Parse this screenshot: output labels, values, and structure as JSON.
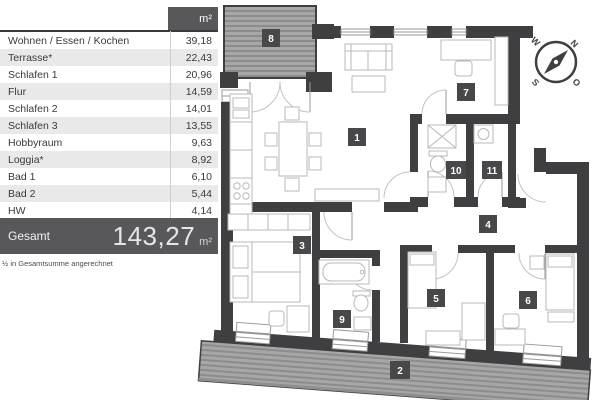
{
  "table": {
    "header_unit": "m²",
    "rows": [
      {
        "name": "Wohnen / Essen / Kochen",
        "value": "39,18"
      },
      {
        "name": "Terrasse*",
        "value": "22,43"
      },
      {
        "name": "Schlafen 1",
        "value": "20,96"
      },
      {
        "name": "Flur",
        "value": "14,59"
      },
      {
        "name": "Schlafen 2",
        "value": "14,01"
      },
      {
        "name": "Schlafen 3",
        "value": "13,55"
      },
      {
        "name": "Hobbyraum",
        "value": "9,63"
      },
      {
        "name": "Loggia*",
        "value": "8,92"
      },
      {
        "name": "Bad 1",
        "value": "6,10"
      },
      {
        "name": "Bad 2",
        "value": "5,44"
      },
      {
        "name": "HW",
        "value": "4,14"
      }
    ],
    "total_label": "Gesamt",
    "total_value": "143,27",
    "total_unit": "m²",
    "footnote": "½ in Gesamtsumme angerechnet"
  },
  "plan": {
    "rooms": [
      {
        "number": "1"
      },
      {
        "number": "2"
      },
      {
        "number": "3"
      },
      {
        "number": "4"
      },
      {
        "number": "5"
      },
      {
        "number": "6"
      },
      {
        "number": "7"
      },
      {
        "number": "8"
      },
      {
        "number": "9"
      },
      {
        "number": "10"
      },
      {
        "number": "11"
      }
    ],
    "compass": {
      "north": "N",
      "east": "O",
      "south": "S",
      "west": "W"
    },
    "colors": {
      "wall": "#3f3f41",
      "badge": "#48484a",
      "accent_dark": "#58585a",
      "row_alt": "#e9e9e9",
      "terrace_fill": "#a7a7a7",
      "terrace_stripe": "#8c8c8c"
    }
  }
}
